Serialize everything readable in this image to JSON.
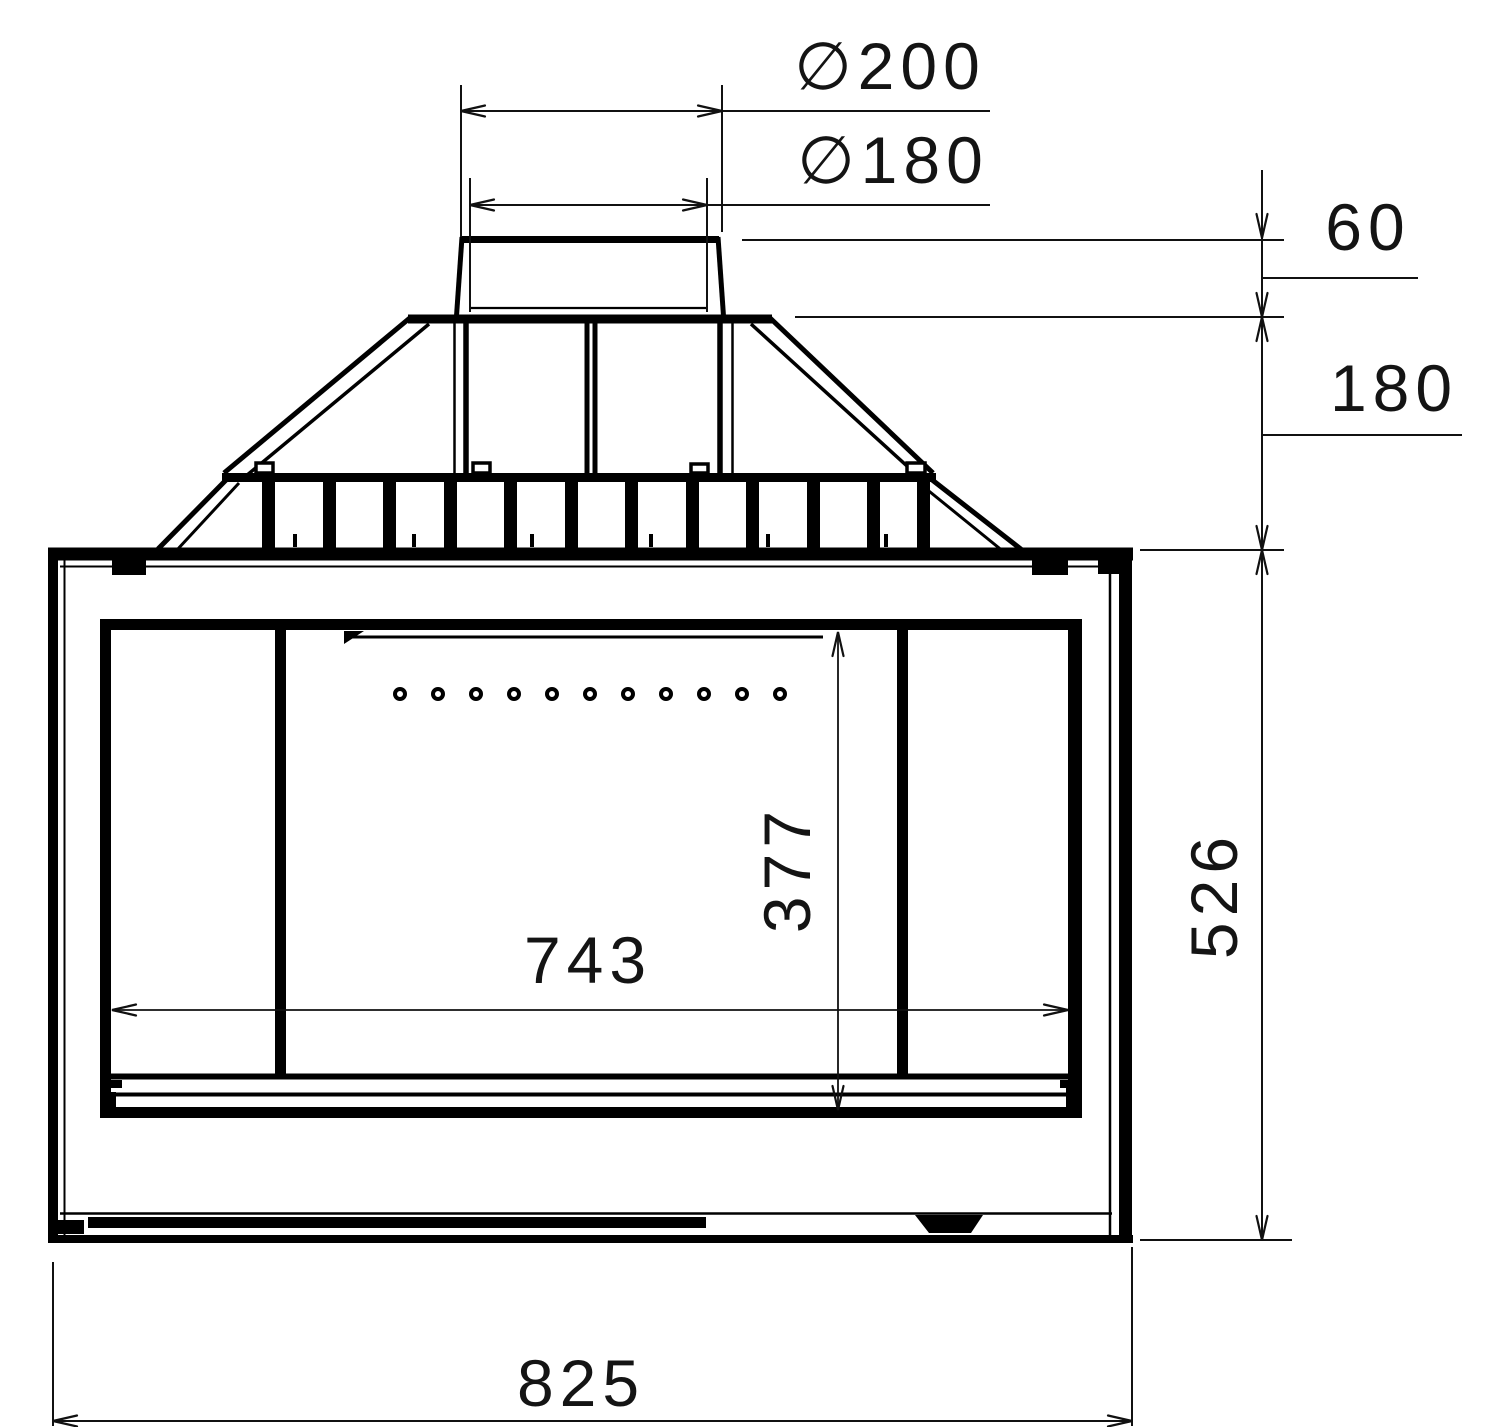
{
  "drawing": {
    "kind": "technical drawing, front elevation of fireplace insert",
    "line_color": "#000000",
    "text_color": "#141414",
    "background": "#ffffff"
  },
  "dimensions": {
    "flue_outer_diameter": {
      "label": "∅200",
      "value": 200
    },
    "flue_inner_diameter": {
      "label": "∅180",
      "value": 180
    },
    "collar_height": {
      "label": "60",
      "value": 60
    },
    "hood_height": {
      "label": "180",
      "value": 180
    },
    "body_height": {
      "label": "526",
      "value": 526
    },
    "opening_height": {
      "label": "377",
      "value": 377
    },
    "opening_width": {
      "label": "743",
      "value": 743
    },
    "overall_width": {
      "label": "825",
      "value": 825
    }
  },
  "features": {
    "grille_slat_count": 12,
    "air_hole_count": 11,
    "mounting_tab_count": 4
  }
}
